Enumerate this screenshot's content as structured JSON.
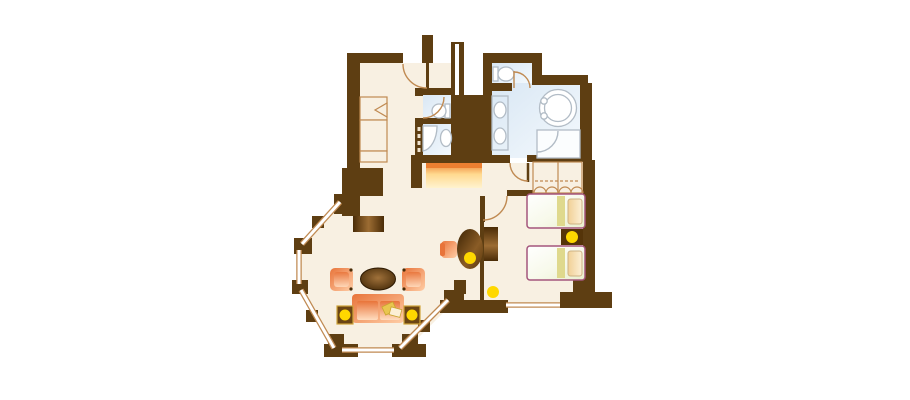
{
  "scene": {
    "type": "floor-plan",
    "description": "hotel suite floor plan with entry hall, guest toilet, shower room, main bathroom with round tub, wardrobe, twin bedroom and octagonal bay-window living room"
  },
  "colors": {
    "wall": "#5e3e12",
    "floor": "#f8f0e2",
    "bath_light": "#f4f9fd",
    "bath": "#d9e7f4",
    "line_tan": "#c08a52",
    "fixture": "#b2bcc6",
    "accent_yellow": "#ffd800",
    "orange_dark": "#e8743a",
    "orange_light": "#ffcda6",
    "seat_light": "#ffddc0",
    "console_top": "#ec7f31",
    "console_mid": "#ffd98f",
    "console_light": "#fff3cf",
    "wood_dark": "#4a2c07",
    "wood_mid": "#9c6c33",
    "bed_outline": "#a4557c",
    "bed_green": "#e9efcd",
    "blanket": "#dfd98d",
    "pillow_dark": "#f1d096",
    "pillow_light": "#fcf0d6",
    "gold": "#cfa43a",
    "throw": "#e9c64f"
  },
  "rooms": [
    {
      "id": "entry-hall",
      "features": [
        "entry-door",
        "closet-with-bifold-door"
      ]
    },
    {
      "id": "guest-wc",
      "features": [
        "toilet",
        "swing-door"
      ]
    },
    {
      "id": "shower-room",
      "features": [
        "corner-shower",
        "sink",
        "pocket-door"
      ]
    },
    {
      "id": "bathroom",
      "features": [
        "wc-compartment-with-toilet",
        "double-vanity",
        "round-bathtub",
        "shower-stall",
        "swing-door"
      ]
    },
    {
      "id": "wardrobe",
      "features": [
        "two-bifold-door-compartments"
      ]
    },
    {
      "id": "bedroom",
      "features": [
        "twin-bed",
        "twin-bed",
        "nightstand-with-lamp",
        "tv-cabinet",
        "floor-lamp",
        "window",
        "swing-door",
        "stepped-wall"
      ]
    },
    {
      "id": "living-room",
      "features": [
        "octagonal-bay-windows",
        "sofa",
        "two-armchairs",
        "coffee-table",
        "two-side-tables-with-lamps",
        "sideboard",
        "oval-desk",
        "desk-chair",
        "desk-lamp",
        "console"
      ]
    }
  ],
  "counts": {
    "lamps": 5,
    "beds": 2,
    "armchairs": 2,
    "doors": 6
  }
}
